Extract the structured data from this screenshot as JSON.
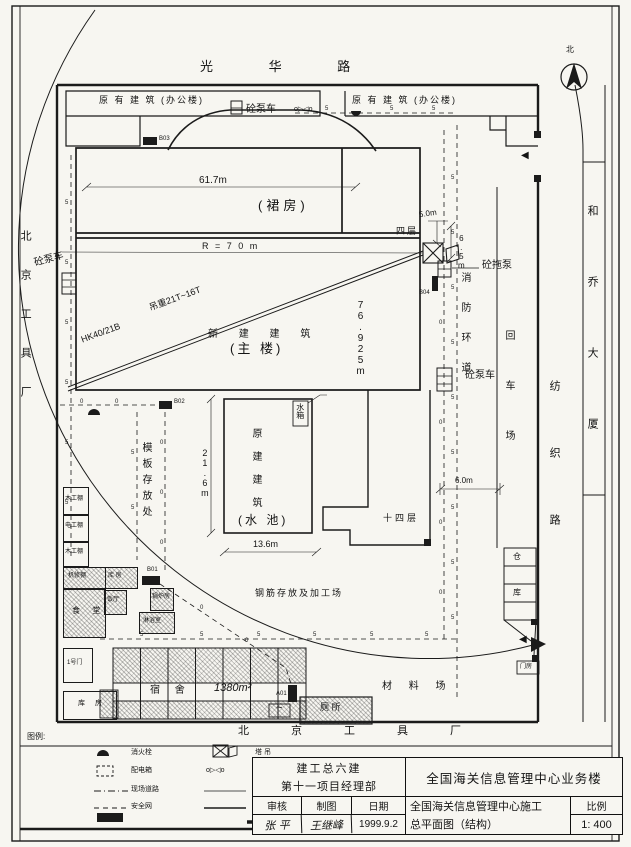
{
  "compass": {
    "char": "北"
  },
  "roads": {
    "north": "光 华 路",
    "east": "纺织路"
  },
  "neighbors": {
    "west": "北京工具厂",
    "south": "北京工具厂",
    "east_building": "和乔大厦"
  },
  "existing": {
    "left": "原 有 建 筑 (办公楼)",
    "right": "原 有 建 筑 (办公楼)"
  },
  "building": {
    "podium": "(裙房)",
    "podium_dim": "61.7m",
    "radius": "R = 7 0 m",
    "tower_line1": "新 建 建 筑",
    "tower_line2": "(主 楼)",
    "tower_dim": "76.925m",
    "crane_model": "HK40/21B",
    "crane_load": "吊重21T~16T",
    "podium_floors": "四层",
    "tower_floors": "十四层",
    "dim_5": "5.0m",
    "dim_65": "6.5m",
    "dim_6": "6.0m"
  },
  "pool": {
    "line1": "原建建筑",
    "line2": "(水 池)",
    "w": "13.6m",
    "h": "21.6m",
    "tank": "水箱"
  },
  "equipment": {
    "pump_truck_top": "砼泵车",
    "pump_truck_west": "砼泵车",
    "pump_truck_east": "砼泵车",
    "trailer_pump": "砼拖泵",
    "b01": "B01",
    "b02": "B02",
    "b03": "B03",
    "b04": "B04",
    "a01": "A01"
  },
  "yards": {
    "rebar": "钢筋存放及加工场",
    "formwork": "模板存放处",
    "material": "材 料 场",
    "turnaround": "回车场",
    "fire_lane": "消防环道",
    "wh1": "仓",
    "wh2": "库",
    "gatehouse": "门房",
    "toilet": "厕 所",
    "dorm_label": "宿 舍",
    "dorm_area": "1380m²"
  },
  "sheds": [
    {
      "label": "木工棚"
    },
    {
      "label": "电工棚"
    },
    {
      "label": "木工棚"
    },
    {
      "label": "机修棚"
    },
    {
      "label": "库 房"
    },
    {
      "label": "食 堂"
    },
    {
      "label": "饭厅"
    },
    {
      "label": "锅炉房"
    },
    {
      "label": "淋浴室"
    },
    {
      "label": "1号门"
    },
    {
      "label": "库 房"
    }
  ],
  "legend": {
    "title": "图例:",
    "items_left": [
      {
        "label": "消火栓"
      },
      {
        "label": "配电箱"
      },
      {
        "label": "现场道路"
      },
      {
        "label": "安全网"
      }
    ],
    "items_right": [
      {
        "label": "塔 吊"
      },
      {
        "label": "水表井"
      },
      {
        "label": "给水管线"
      },
      {
        "label": "现场围墙"
      }
    ]
  },
  "titleblock": {
    "org1": "建工总六建",
    "org2": "第十一项目经理部",
    "project": "全国海关信息管理中心业务楼",
    "c1": "审核",
    "c2": "制图",
    "c3": "日期",
    "v1": "张  平",
    "v2": "王继峰",
    "v3": "1999.9.2",
    "dwg1": "全国海关信息管理中心施工",
    "dwg2": "总平面图（结构）",
    "scale_label": "比例",
    "scale": "1: 400"
  },
  "symbols": {
    "water_meter": "o▷◁o",
    "gate": "◀",
    "wave": "~"
  },
  "ticks": {
    "fence": "5",
    "pipe": "0"
  }
}
